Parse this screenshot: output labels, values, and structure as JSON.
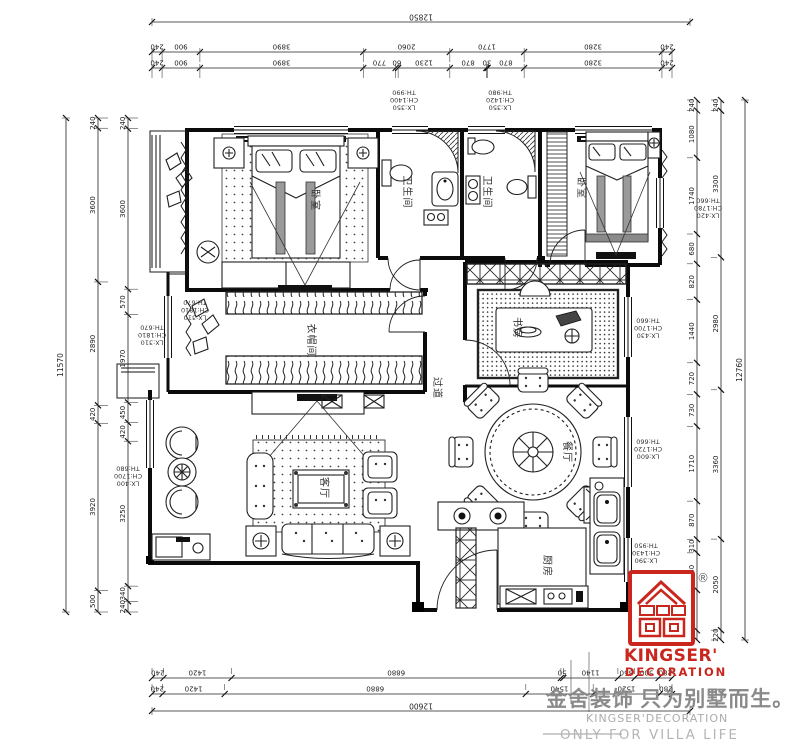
{
  "rooms": {
    "bedroom_master": {
      "label": "卧室"
    },
    "bedroom_second": {
      "label": "卧室"
    },
    "bathroom_master": {
      "label": "卫生间"
    },
    "bathroom_guest": {
      "label": "卫生间"
    },
    "cloakroom": {
      "label": "衣帽间"
    },
    "living_room": {
      "label": "客厅"
    },
    "hallway": {
      "label": "过道"
    },
    "dining_room": {
      "label": "餐厅"
    },
    "kitchen": {
      "label": "厨房"
    },
    "study": {
      "label": "书房"
    }
  },
  "window_labels": {
    "top_bath_left": {
      "th": "TH:990",
      "ch": "CH:1400",
      "lx": "LX:350"
    },
    "top_bath_right": {
      "th": "TH:980",
      "ch": "CH:1420",
      "lx": "LX:350"
    },
    "left_cloakroom_outer": {
      "th": "TH:670",
      "ch": "CH:1810",
      "lx": "LX:310"
    },
    "left_cloakroom_inner": {
      "th": "TH:670",
      "ch": "CH:1810",
      "lx": "LX:310"
    },
    "left_living": {
      "th": "TH:680",
      "ch": "CH:1700",
      "lx": "LX:400"
    },
    "right_bedroom": {
      "th": "TH:660",
      "ch": "CH:1780",
      "lx": "LX:420"
    },
    "right_study": {
      "th": "TH:660",
      "ch": "CH:1700",
      "lx": "LX:430"
    },
    "right_dining": {
      "th": "TH:660",
      "ch": "CH:1720",
      "lx": "LX:600"
    },
    "right_kitchen": {
      "th": "TH:950",
      "ch": "CH:1430",
      "lx": "LX:390"
    }
  },
  "dimensions": {
    "top": {
      "total": [
        "12850"
      ],
      "row1": [
        "240",
        "900",
        "3890",
        "2060",
        "1770",
        "3280",
        "240"
      ],
      "row2": [
        "240",
        "900",
        "3890",
        "770",
        "60",
        "1230",
        "870",
        "30",
        "870",
        "3280",
        "240"
      ]
    },
    "bottom": {
      "row1": [
        "240",
        "1420",
        "6880",
        "50",
        "1140",
        "350",
        "500",
        "280"
      ],
      "row2": [
        "240",
        "1420",
        "6880",
        "1540",
        "1520",
        "280"
      ],
      "total": [
        "12600"
      ]
    },
    "left": {
      "inner": [
        "240",
        "3600",
        "570",
        "1970",
        "450",
        "420",
        "3250",
        "340",
        "240"
      ],
      "outer": [
        "240",
        "3600",
        "2890",
        "420",
        "3920",
        "500"
      ],
      "total": [
        "11570"
      ]
    },
    "right": {
      "inner": [
        "240",
        "1080",
        "1740",
        "680",
        "820",
        "1440",
        "720",
        "730",
        "1710",
        "870",
        "310",
        "850",
        "920",
        "220"
      ],
      "outer": [
        "240",
        "3300",
        "2980",
        "3360",
        "2050",
        "220"
      ],
      "total": [
        "12760"
      ]
    }
  },
  "logo": {
    "brand": "KINGSER'",
    "brand_sub": "DECORATION",
    "registered": "®",
    "slogan_cn": "金舍装饰 只为别墅而生。",
    "slogan_en_line1": "KINGSER'DECORATION",
    "slogan_en_line2": "ONLY FOR VILLA LIFE",
    "brand_red": "#c9261d",
    "slogan_gray": "#8a8a8a"
  }
}
